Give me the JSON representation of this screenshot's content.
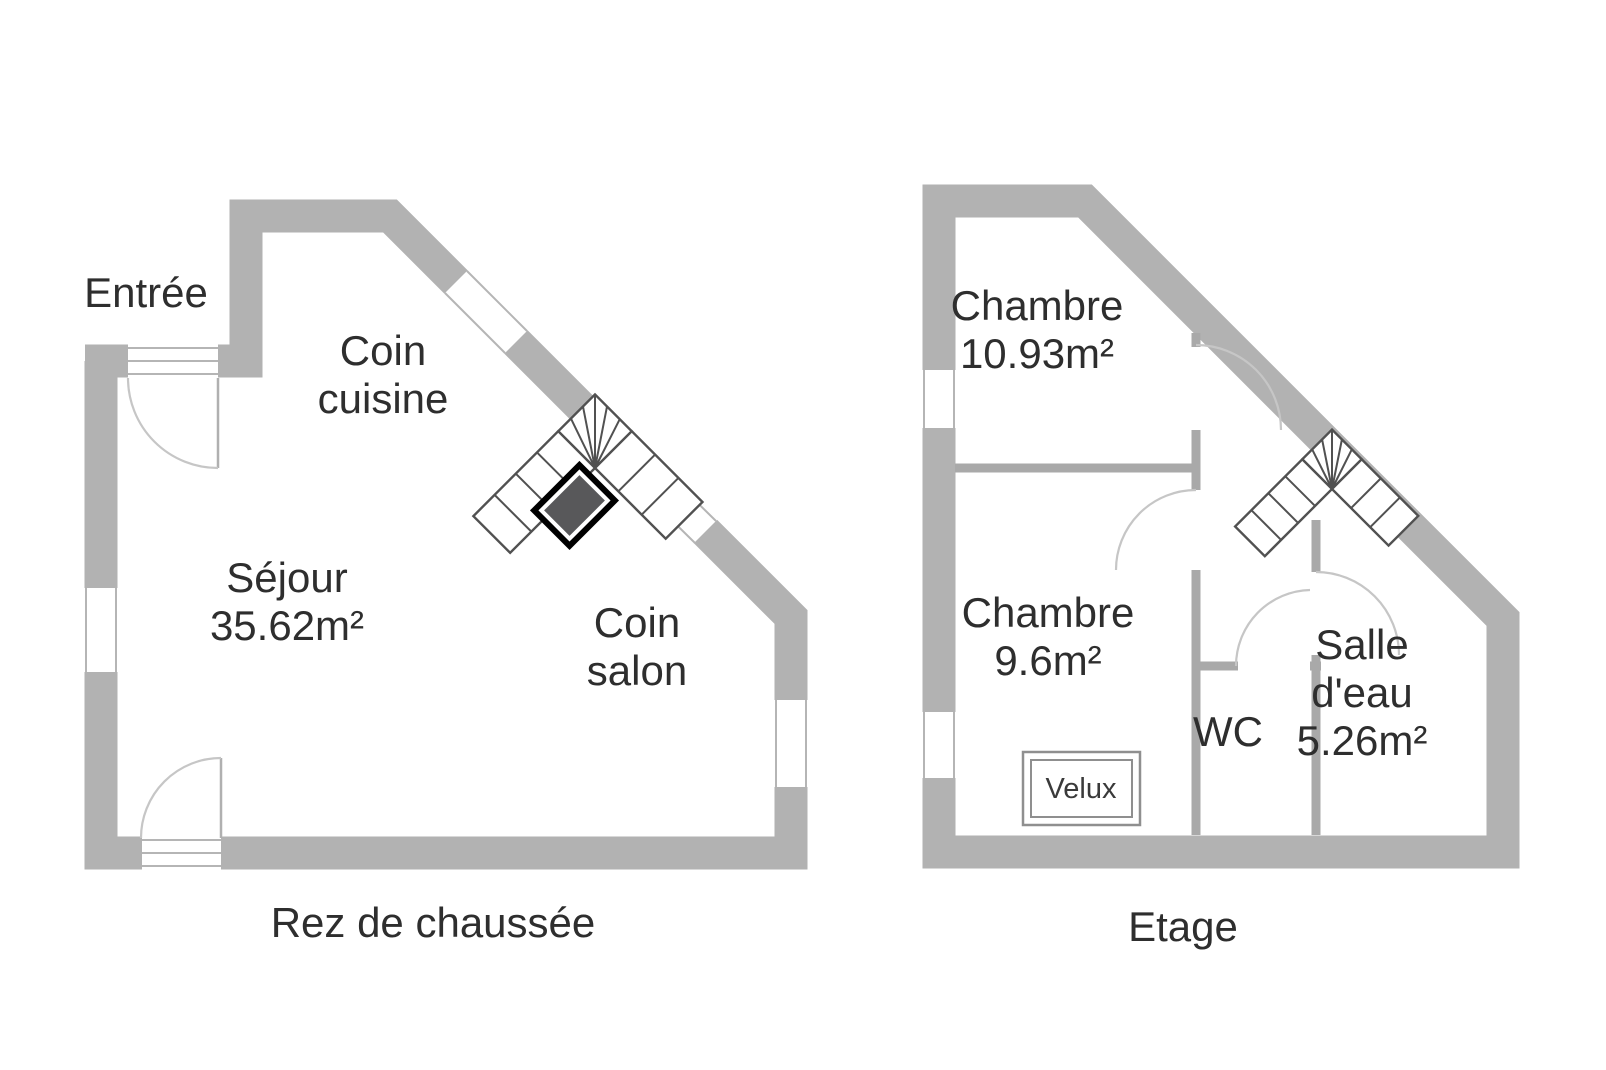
{
  "ground_floor": {
    "title": "Rez de chaussée",
    "entree": "Entrée",
    "coin_cuisine_line1": "Coin",
    "coin_cuisine_line2": "cuisine",
    "sejour_line1": "Séjour",
    "sejour_line2": "35.62m²",
    "coin_salon_line1": "Coin",
    "coin_salon_line2": "salon"
  },
  "upper_floor": {
    "title": "Etage",
    "chambre_large_line1": "Chambre",
    "chambre_large_line2": "10.93m²",
    "chambre_small_line1": "Chambre",
    "chambre_small_line2": "9.6m²",
    "wc": "WC",
    "salle_eau_line1": "Salle",
    "salle_eau_line2": "d'eau",
    "salle_eau_line3": "5.26m²",
    "velux": "Velux"
  },
  "colors": {
    "background": "#ffffff",
    "exterior_wall": "#b2b2b2",
    "interior_wall": "#a9a9a9",
    "stair_stroke": "#515151",
    "stair_core_fill": "#58585a",
    "stair_core_border": "#000000",
    "door_arc": "#c6c6c6",
    "text": "#2e2e2e"
  }
}
